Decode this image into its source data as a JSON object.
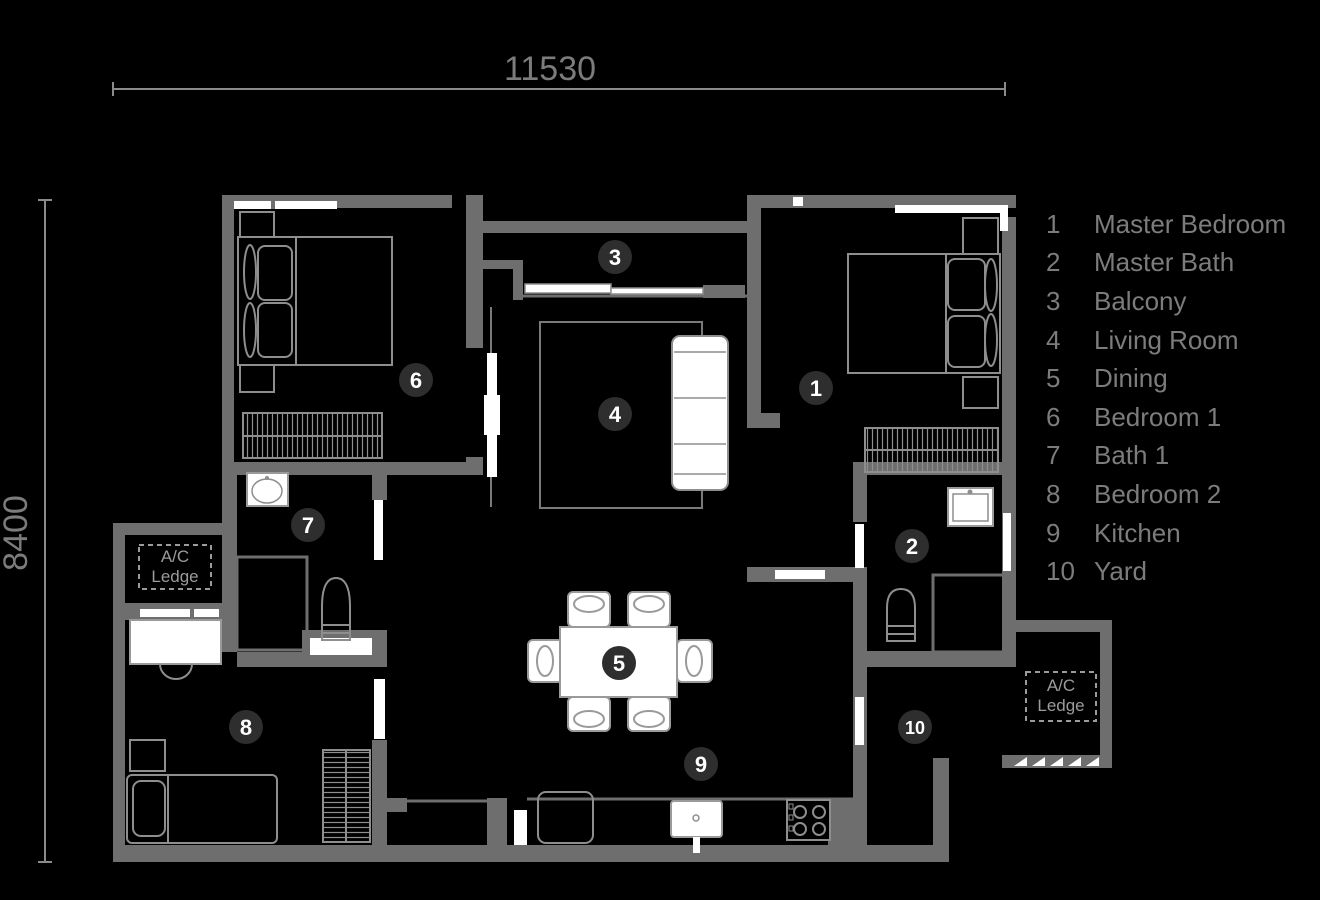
{
  "dimensions": {
    "width_label": "11530",
    "height_label": "8400"
  },
  "ac_ledge": {
    "line1": "A/C",
    "line2": "Ledge"
  },
  "legend": {
    "items": [
      {
        "number": "1",
        "label": "Master Bedroom"
      },
      {
        "number": "2",
        "label": "Master Bath"
      },
      {
        "number": "3",
        "label": "Balcony"
      },
      {
        "number": "4",
        "label": "Living Room"
      },
      {
        "number": "5",
        "label": "Dining"
      },
      {
        "number": "6",
        "label": "Bedroom 1"
      },
      {
        "number": "7",
        "label": "Bath 1"
      },
      {
        "number": "8",
        "label": "Bedroom 2"
      },
      {
        "number": "9",
        "label": "Kitchen"
      },
      {
        "number": "10",
        "label": "Yard"
      }
    ]
  },
  "colors": {
    "background": "#000000",
    "wall": "#6e6e6e",
    "furniture_outline": "#8e8e8e",
    "fixture_white": "#ffffff",
    "marker_background": "#2e2e2e",
    "marker_text": "#ffffff",
    "label_text": "#7c7c7c",
    "ac_text": "#9b9b9b"
  }
}
